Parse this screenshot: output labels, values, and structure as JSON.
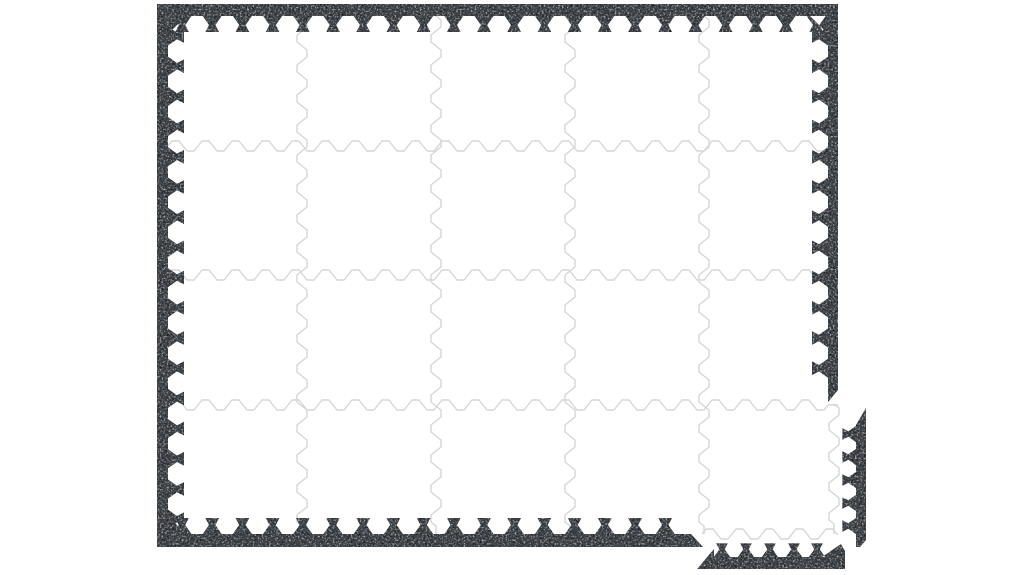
{
  "page": {
    "background_color": "#ffffff"
  },
  "product": {
    "kind": "interlocking-foam-play-mat",
    "grid": {
      "columns": 5,
      "rows": 4
    },
    "tile": {
      "fill_color": "#ffffff",
      "seam_color": "#d4d6d7",
      "interlock_style": "dovetail-puzzle-edge"
    },
    "border": {
      "base_color": "#4a4f55",
      "dark_speck_color": "#22262b",
      "light_speck_color": "#c6cacd",
      "texture": "speckled-eva-foam",
      "tooth_style": "dovetail-teeth-pointing-inward",
      "coverage": {
        "top": "full",
        "left": "full",
        "right": "partial-stops-above-bottom-row",
        "bottom": "partial-stops-before-last-column"
      }
    },
    "loose_pieces": [
      {
        "id": "edge-strip-vertical",
        "orientation": "vertical",
        "teeth": 5,
        "location": "right-of-mat-lower"
      },
      {
        "id": "edge-strip-horizontal",
        "orientation": "horizontal",
        "teeth": 5,
        "location": "below-mat-right"
      }
    ]
  }
}
